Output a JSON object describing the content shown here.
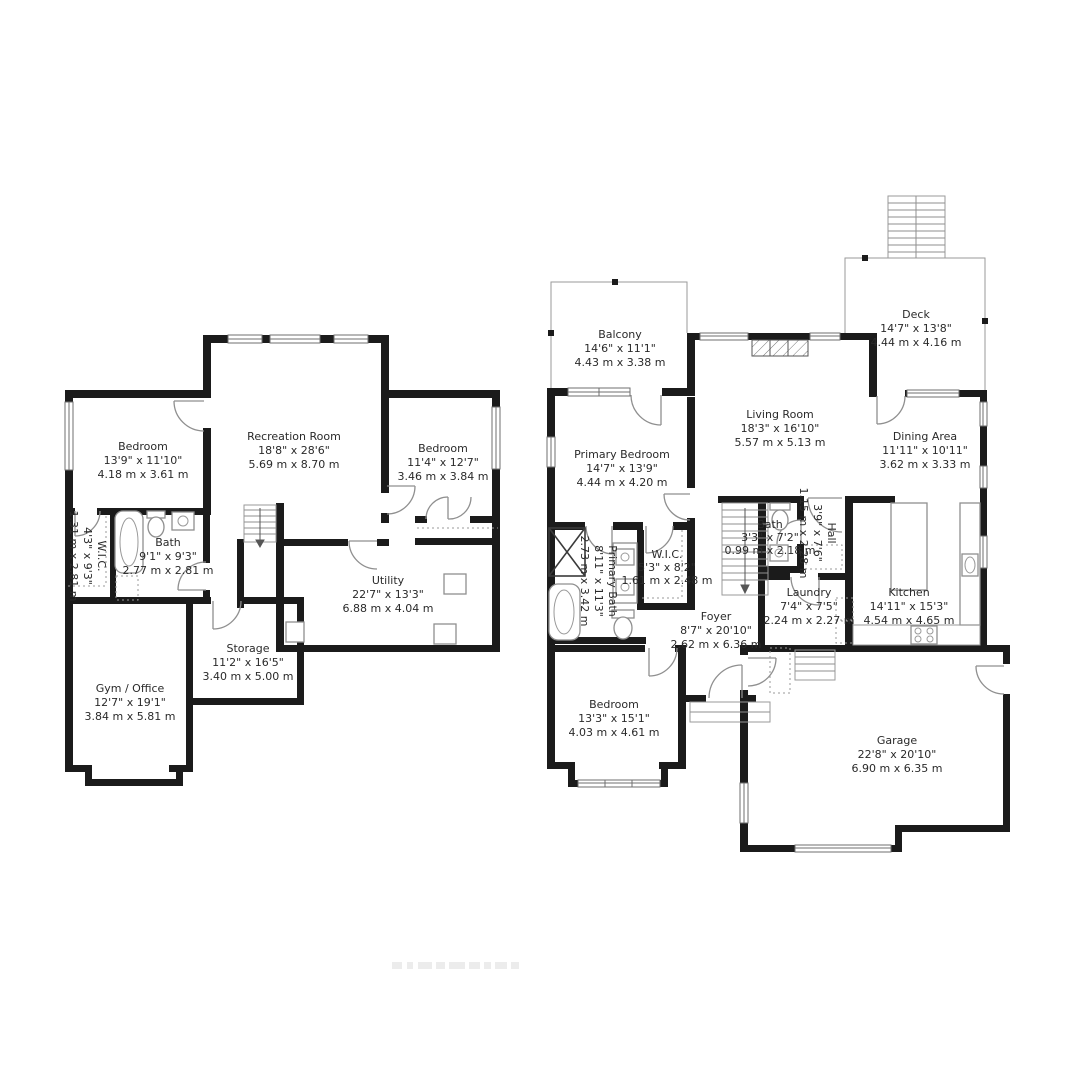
{
  "colors": {
    "walls": "#1b1b1b",
    "thin_lines": "#8f8f8f",
    "label_text": "#2a2a2a",
    "background": "#ffffff"
  },
  "rooms": {
    "lower": [
      {
        "name": "Bedroom",
        "imperial": "13'9\" x 11'10\"",
        "metric": "4.18 m x 3.61 m"
      },
      {
        "name": "Recreation Room",
        "imperial": "18'8\" x 28'6\"",
        "metric": "5.69 m x 8.70 m"
      },
      {
        "name": "Bedroom",
        "imperial": "11'4\" x 12'7\"",
        "metric": "3.46 m x 3.84 m"
      },
      {
        "name": "W.I.C.",
        "imperial": "4'3\" x 9'3\"",
        "metric": "1.31 m x 2.81 m"
      },
      {
        "name": "Bath",
        "imperial": "9'1\" x 9'3\"",
        "metric": "2.77 m x 2.81 m"
      },
      {
        "name": "Utility",
        "imperial": "22'7\" x 13'3\"",
        "metric": "6.88 m x 4.04 m"
      },
      {
        "name": "Storage",
        "imperial": "11'2\" x 16'5\"",
        "metric": "3.40 m x 5.00 m"
      },
      {
        "name": "Gym / Office",
        "imperial": "12'7\" x 19'1\"",
        "metric": "3.84 m x 5.81 m"
      }
    ],
    "upper": [
      {
        "name": "Balcony",
        "imperial": "14'6\" x 11'1\"",
        "metric": "4.43 m x 3.38 m"
      },
      {
        "name": "Deck",
        "imperial": "14'7\" x 13'8\"",
        "metric": "4.44 m x 4.16 m"
      },
      {
        "name": "Living Room",
        "imperial": "18'3\" x 16'10\"",
        "metric": "5.57 m x 5.13 m"
      },
      {
        "name": "Primary Bedroom",
        "imperial": "14'7\" x 13'9\"",
        "metric": "4.44 m x 4.20 m"
      },
      {
        "name": "Dining Area",
        "imperial": "11'11\" x 10'11\"",
        "metric": "3.62 m x 3.33 m"
      },
      {
        "name": "Primary Bath",
        "imperial": "8'11\" x 11'3\"",
        "metric": "2.73 m x 3.42 m"
      },
      {
        "name": "W.I.C.",
        "imperial": "5'3\" x 8'2\"",
        "metric": "1.61 m x 2.48 m"
      },
      {
        "name": "Bath",
        "imperial": "3'3\" x 7'2\"",
        "metric": "0.99 m x 2.18 m"
      },
      {
        "name": "Hall",
        "imperial": "3'9\" x 7'6\"",
        "metric": "1.15 m x 2.28 m"
      },
      {
        "name": "Foyer",
        "imperial": "8'7\" x 20'10\"",
        "metric": "2.62 m x 6.36 m"
      },
      {
        "name": "Laundry",
        "imperial": "7'4\" x 7'5\"",
        "metric": "2.24 m x 2.27 m"
      },
      {
        "name": "Kitchen",
        "imperial": "14'11\" x 15'3\"",
        "metric": "4.54 m x 4.65 m"
      },
      {
        "name": "Bedroom",
        "imperial": "13'3\" x 15'1\"",
        "metric": "4.03 m x 4.61 m"
      },
      {
        "name": "Garage",
        "imperial": "22'8\" x 20'10\"",
        "metric": "6.90 m x 6.35 m"
      }
    ]
  }
}
